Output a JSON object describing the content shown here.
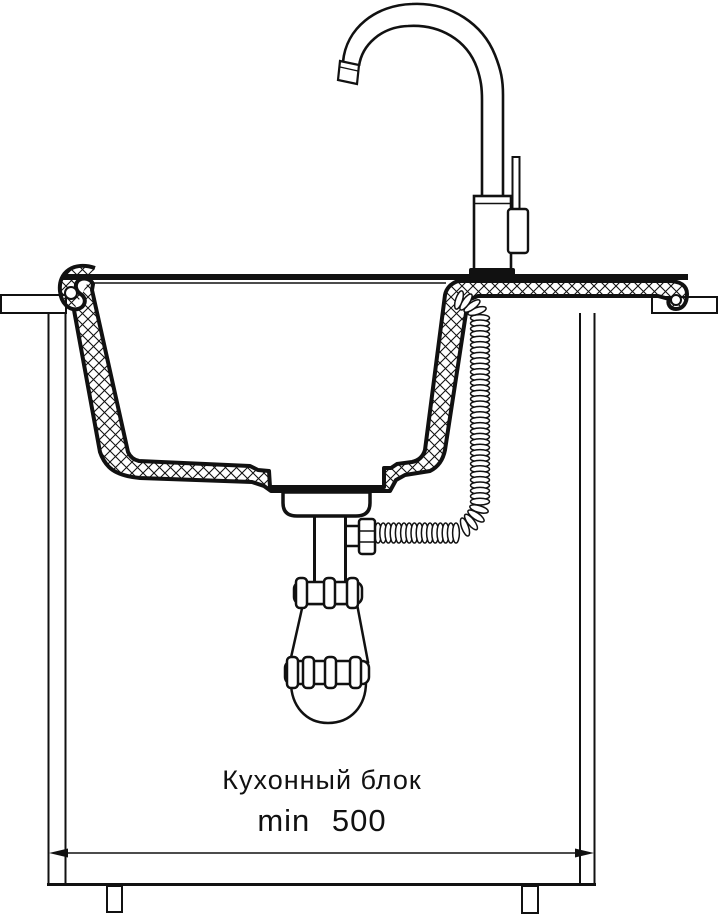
{
  "diagram": {
    "labels": {
      "cabinet_unit": "Кухонный блок",
      "min_width": "min 500"
    },
    "colors": {
      "line": "#111111",
      "background": "#ffffff"
    }
  }
}
